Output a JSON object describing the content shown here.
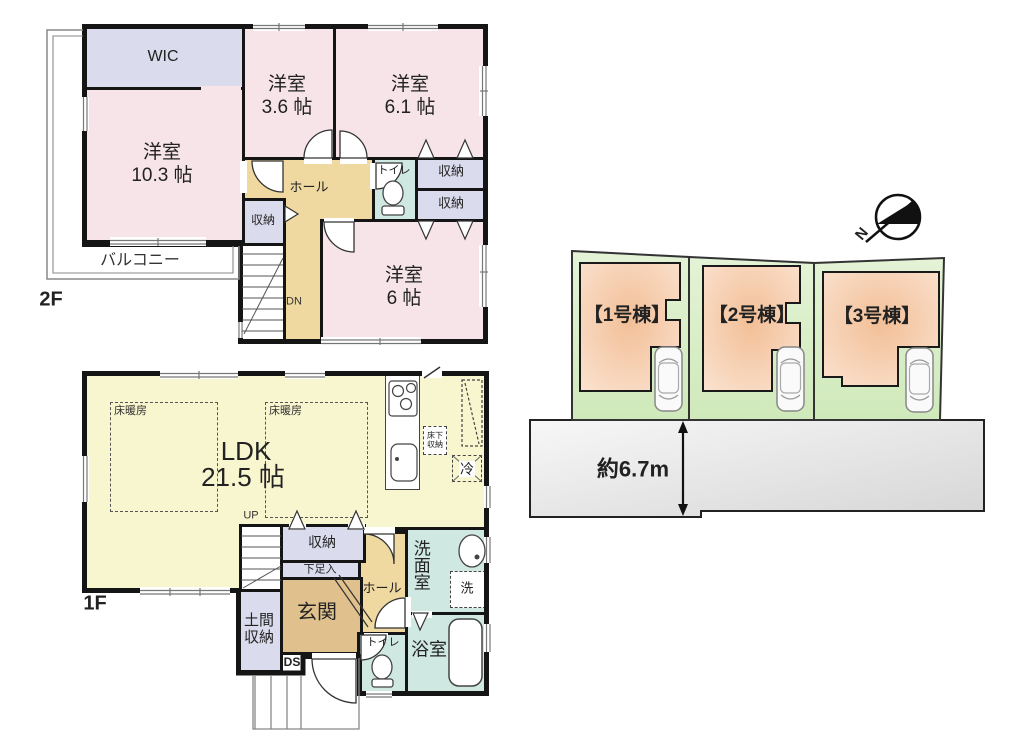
{
  "plan_2f": {
    "floor_label": "2F",
    "balcony_label": "バルコニー",
    "wic_label": "WIC",
    "room_10_3": {
      "name": "洋室",
      "size": "10.3 帖"
    },
    "room_3_6": {
      "name": "洋室",
      "size": "3.6 帖"
    },
    "room_6_1": {
      "name": "洋室",
      "size": "6.1 帖"
    },
    "room_6": {
      "name": "洋室",
      "size": "6 帖"
    },
    "hall_label": "ホール",
    "toilet_label": "トイレ",
    "closet_label": "収納",
    "dn_label": "DN"
  },
  "plan_1f": {
    "floor_label": "1F",
    "ldk": {
      "name": "LDK",
      "size": "21.5 帖"
    },
    "floor_heating_label": "床暖房",
    "underfloor_storage_label": "床下収納",
    "fridge_label": "冷",
    "up_label": "UP",
    "closet_label": "収納",
    "shoe_cabinet_label": "下足入",
    "hall_label": "ホール",
    "entrance_label": "玄関",
    "doma_storage_label": "土間収納",
    "ds_label": "DS",
    "toilet_label": "トイレ",
    "bath_label": "浴室",
    "washroom_label": "洗面室",
    "washer_label": "洗"
  },
  "site_plan": {
    "north_label": "N",
    "building_labels": [
      "【1号棟】",
      "【2号棟】",
      "【3号棟】"
    ],
    "road_width_label": "約6.7m"
  },
  "colors": {
    "wall": "#151515",
    "room_pink": "#f6e4e8",
    "closet_lavender": "#dbdbee",
    "hall_tan": "#efd9a0",
    "entrance_tan": "#e0c08c",
    "wet_teal": "#cfe9e2",
    "ldk_yellow": "#f8f6cf",
    "lot_green": "#d8eec6",
    "building_peach": "#f3c5a2",
    "road_gray": "#e8e8e8"
  }
}
